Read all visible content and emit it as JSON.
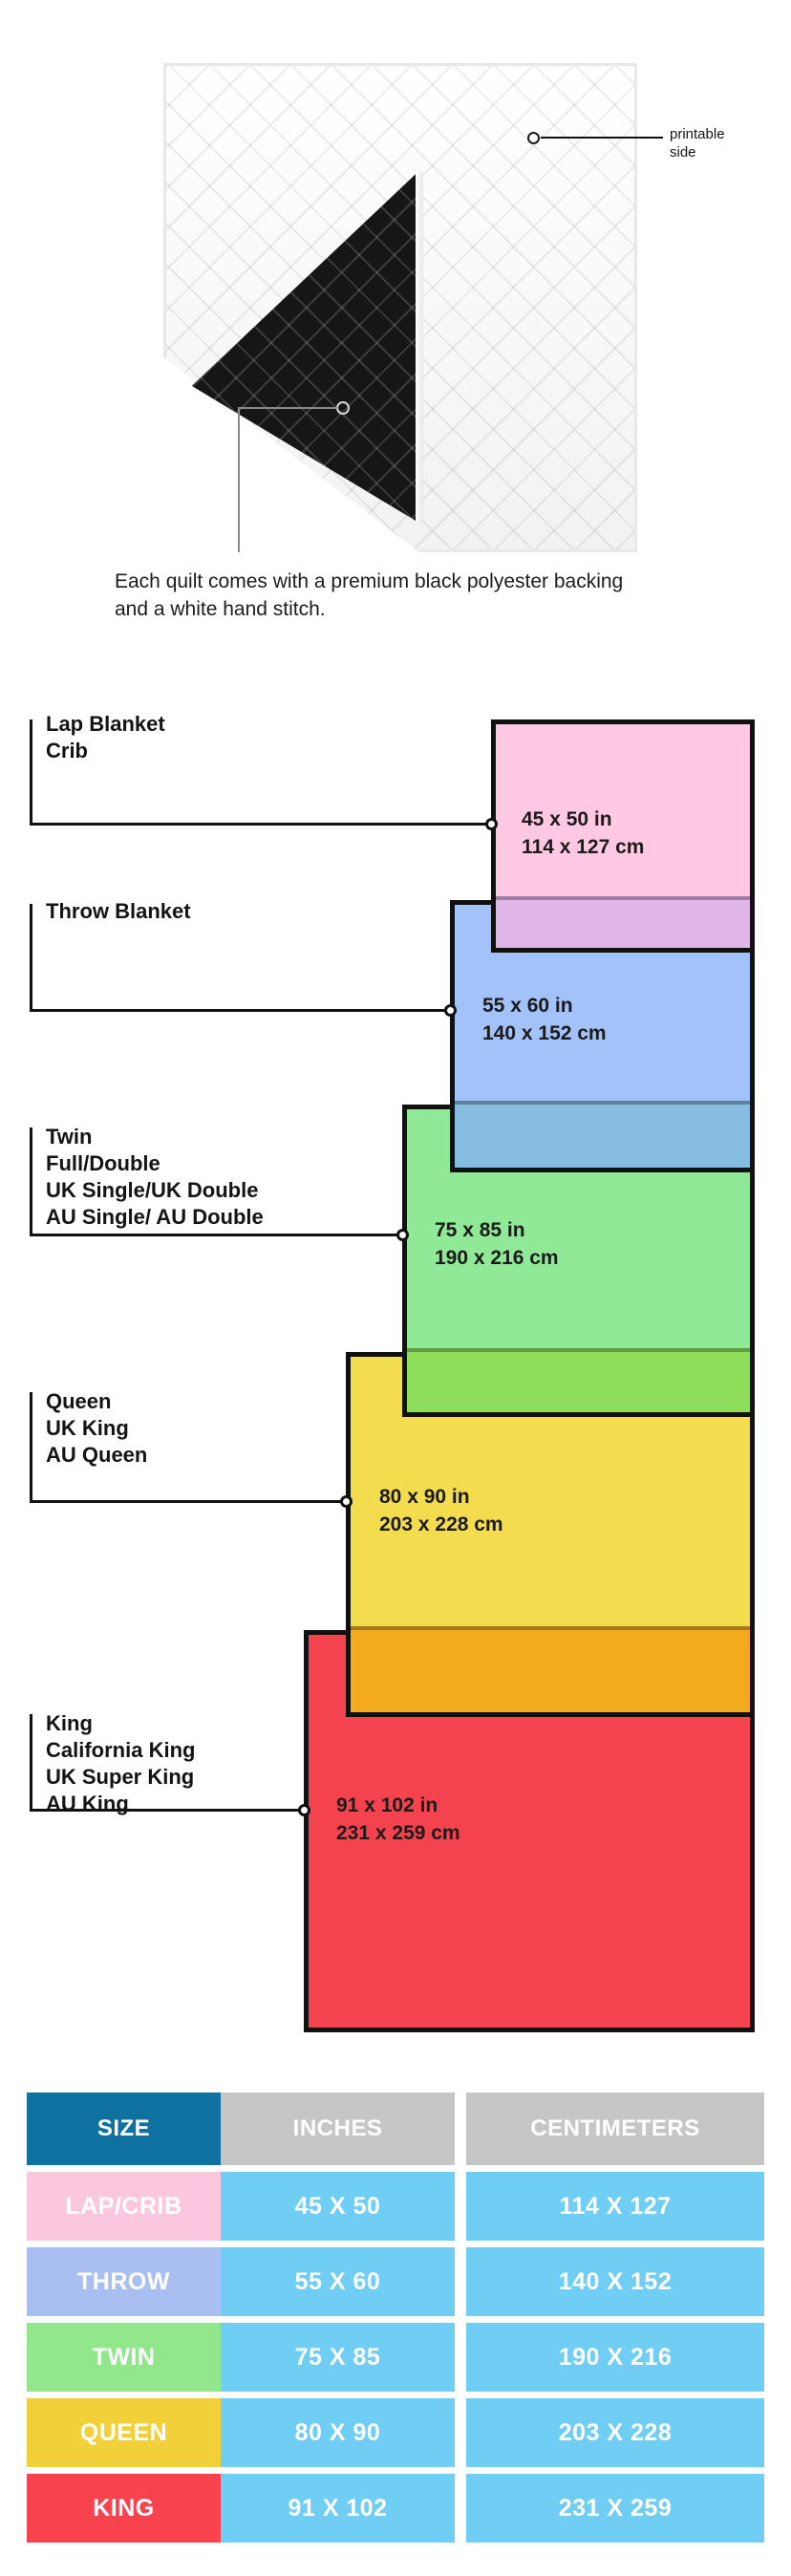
{
  "hero": {
    "printable_callout": "printable side",
    "caption": "Each quilt comes with a premium black polyester backing and a white hand stitch."
  },
  "diagram": {
    "entries": [
      {
        "key": "lap-crib",
        "label_lines": [
          "Lap Blanket",
          "Crib"
        ],
        "size_in": "45 x 50 in",
        "size_cm": "114 x 127 cm",
        "fill": "#FFC9E3",
        "overlap_fill": "#E0B6E8"
      },
      {
        "key": "throw",
        "label_lines": [
          "Throw Blanket"
        ],
        "size_in": "55 x 60 in",
        "size_cm": "140 x 152 cm",
        "fill": "#A3C2FA",
        "overlap_fill": "#85BCE0"
      },
      {
        "key": "twin",
        "label_lines": [
          "Twin",
          "Full/Double",
          "UK Single/UK Double",
          "AU Single/ AU Double"
        ],
        "size_in": "75 x 85 in",
        "size_cm": "190 x 216 cm",
        "fill": "#90E996",
        "overlap_fill": "#8EDE5B"
      },
      {
        "key": "queen",
        "label_lines": [
          "Queen",
          "UK King",
          "AU Queen"
        ],
        "size_in": "80 x 90 in",
        "size_cm": "203 x 228 cm",
        "fill": "#F3DC4E",
        "overlap_fill": "#F3AB1D"
      },
      {
        "key": "king",
        "label_lines": [
          "King",
          "California King",
          "UK Super King",
          "AU King"
        ],
        "size_in": "91 x 102 in",
        "size_cm": "231 x 259 cm",
        "fill": "#F4434F",
        "overlap_fill": null
      }
    ]
  },
  "table": {
    "headers": [
      "SIZE",
      "INCHES",
      "CENTIMETERS"
    ],
    "header_size_bg": "#0F719F",
    "header_other_bg": "#C6C6C6",
    "value_bg": "#70CDF4",
    "rows": [
      {
        "label": "LAP/CRIB",
        "inches": "45 X 50",
        "cm": "114 X 127",
        "label_bg": "#FAC7DE"
      },
      {
        "label": "THROW",
        "inches": "55 X 60",
        "cm": "140 X 152",
        "label_bg": "#A9BFF2"
      },
      {
        "label": "TWIN",
        "inches": "75 X 85",
        "cm": "190 X 216",
        "label_bg": "#92E78C"
      },
      {
        "label": "QUEEN",
        "inches": "80 X 90",
        "cm": "203 X 228",
        "label_bg": "#F2D03A"
      },
      {
        "label": "KING",
        "inches": "91 X 102",
        "cm": "231 X 259",
        "label_bg": "#F8434F"
      }
    ]
  }
}
